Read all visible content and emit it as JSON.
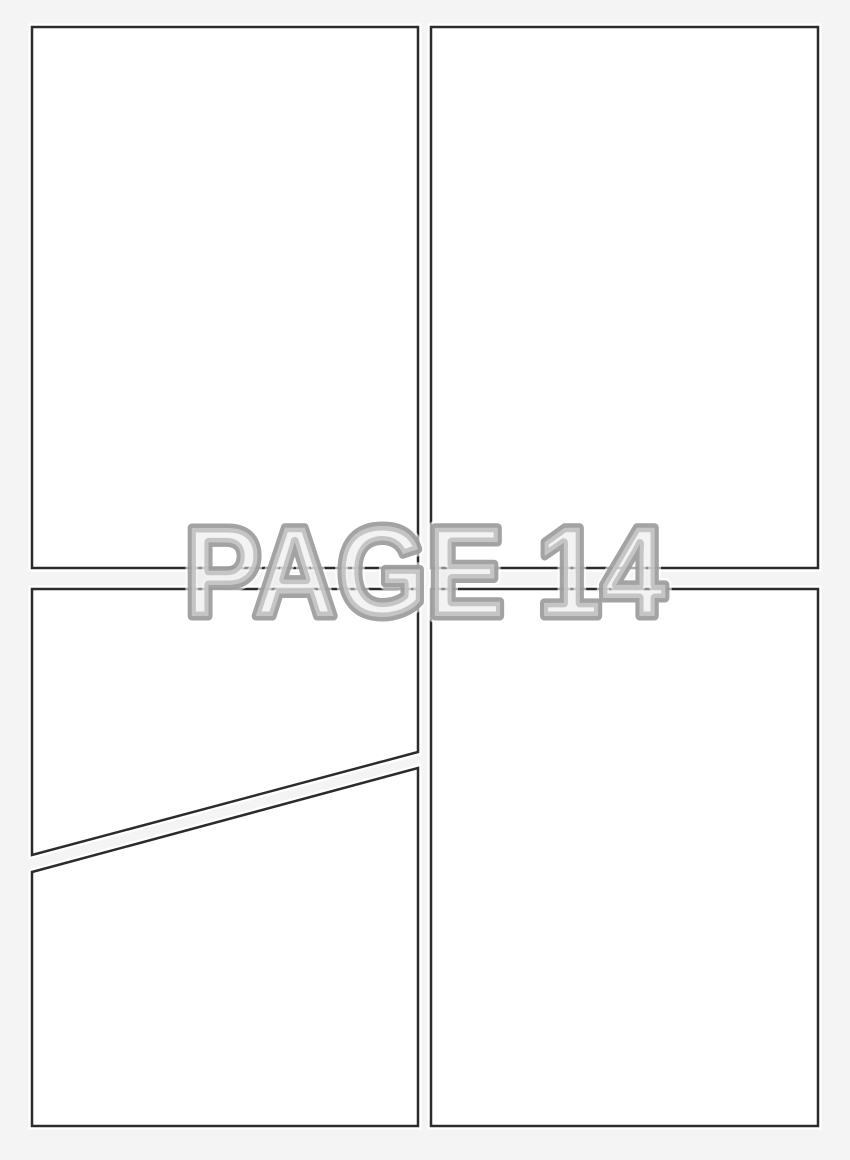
{
  "page": {
    "label": "PAGE 14",
    "background_color": "#f4f4f4",
    "panel_fill": "#ffffff",
    "panel_border_color": "#2b2b2b",
    "panel_halo_color": "#ffffff",
    "label_fill_color": "#e8e8e8",
    "label_outline_color": "#9b9b9b",
    "label_halo_color": "#ffffff"
  },
  "panels": [
    {
      "id": "top-left",
      "shape": "rectangle"
    },
    {
      "id": "top-right",
      "shape": "rectangle"
    },
    {
      "id": "bottom-left-upper",
      "shape": "diagonal-polygon"
    },
    {
      "id": "bottom-left-lower",
      "shape": "diagonal-polygon"
    },
    {
      "id": "bottom-right",
      "shape": "rectangle"
    }
  ]
}
